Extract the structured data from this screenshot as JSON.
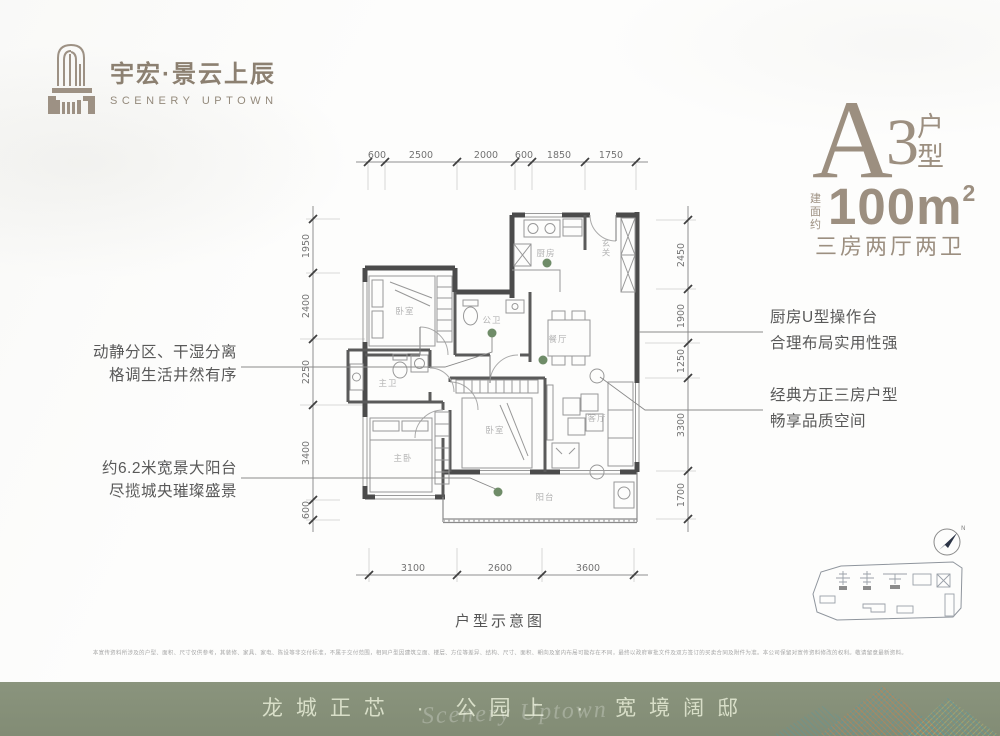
{
  "brand": {
    "name_cn": "宇宏·景云上辰",
    "name_en": "SCENERY UPTOWN"
  },
  "unit": {
    "letter": "A",
    "number": "3",
    "suffix": "户型",
    "area_prefix": "建面约",
    "area_main": "100m",
    "area_exp": "2",
    "layout": "三房两厅两卫"
  },
  "plan": {
    "caption": "户型示意图",
    "compass_label": "N",
    "dims_top": [
      "600",
      "2500",
      "2000",
      "600",
      "1850",
      "1750"
    ],
    "dims_left": [
      "1950",
      "2400",
      "2250",
      "3400",
      "600"
    ],
    "dims_right": [
      "2450",
      "1900",
      "1250",
      "3300",
      "1700"
    ],
    "dims_bottom": [
      "3100",
      "2600",
      "3600"
    ],
    "rooms": {
      "bedroom1": "卧室",
      "guest_bath": "公卫",
      "kitchen": "厨房",
      "foyer": "玄关",
      "dining": "餐厅",
      "master_bath": "主卫",
      "master_bedroom": "主卧",
      "bedroom2": "卧室",
      "living": "客厅",
      "balcony": "阳台"
    }
  },
  "annotations": {
    "left1_line1": "动静分区、干湿分离",
    "left1_line2": "格调生活井然有序",
    "left2_line1": "约6.2米宽景大阳台",
    "left2_line2": "尽揽城央璀璨盛景",
    "right1_line1": "厨房U型操作台",
    "right1_line2": "合理布局实用性强",
    "right2_line1": "经典方正三房户型",
    "right2_line2": "畅享品质空间"
  },
  "footer": {
    "disclaimer": "本宣传资料所涉及的户型、面积、尺寸仅供参考，其装修、家具、家电、陈设等非交付标准，不属于交付范围，相同户型因建筑立面、楼层、方位等差异、结构、尺寸、面积、朝向及室内布局可能存在不同，最终以政府审批文件及双方签订的买卖合同及附件为准。本公司保留对宣传资料修改的权利。敬请留意最新资料。",
    "banner_text": "龙城正芯 · 公园上 · 宽境阔邸",
    "banner_script": "Scenery Uptown"
  },
  "colors": {
    "brand": "#9c8f80",
    "banner_bg": "#87917a",
    "wall": "#4b4b4b",
    "dot": "#6f8c68"
  }
}
